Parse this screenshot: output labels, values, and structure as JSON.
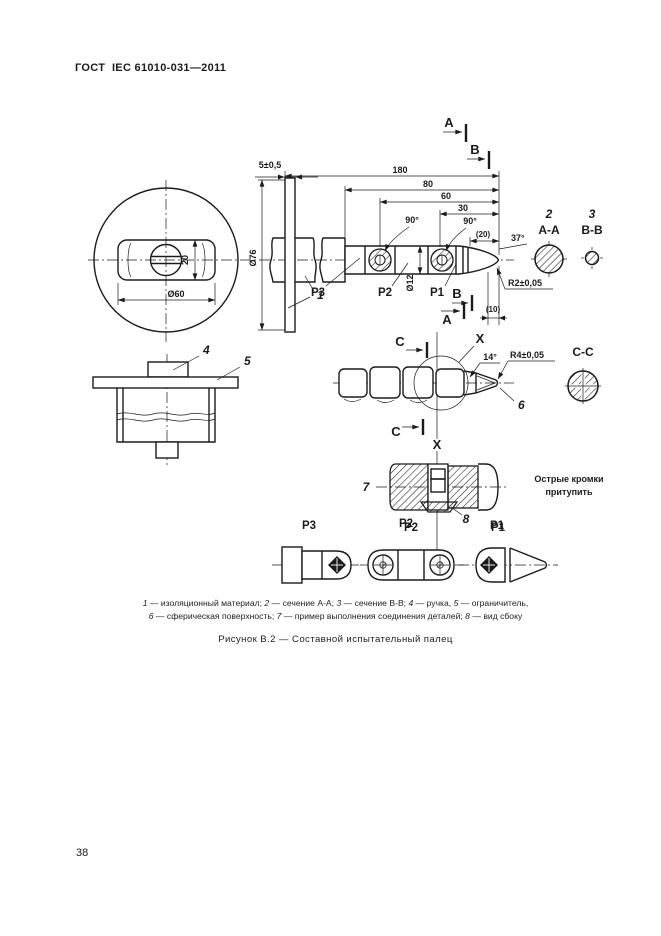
{
  "page": {
    "header": "ГОСТ  IEC 61010-031—2011",
    "page_number": "38"
  },
  "colors": {
    "ink": "#1b1b1b",
    "paper": "#ffffff"
  },
  "figure": {
    "caption": "Рисунок В.2 — Составной испытательный палец",
    "legend": {
      "line1": [
        {
          "n": "1",
          "t": " — изоляционный материал; "
        },
        {
          "n": "2",
          "t": " — сечение А-А; "
        },
        {
          "n": "3",
          "t": " — сечение В-В; "
        },
        {
          "n": "4",
          "t": " — ручка, "
        },
        {
          "n": "5",
          "t": " — ограничитель,"
        }
      ],
      "line2": [
        {
          "n": "6",
          "t": " — сферическая поверхность; "
        },
        {
          "n": "7",
          "t": " — пример выполнения соединения деталей; "
        },
        {
          "n": "8",
          "t": " — вид сбоку"
        }
      ]
    }
  },
  "drawing": {
    "dims": {
      "d180": "180",
      "d80": "80",
      "d60": "60",
      "d30": "30",
      "d5": "5±0,5",
      "d76": "Ø76",
      "d60d": "Ø60",
      "d20": "20",
      "d12": "Ø12",
      "d20p": "(20)",
      "d10p": "(10)",
      "a90": "90°",
      "a37": "37°",
      "a14": "14°",
      "r2": "R2±0,05",
      "r4": "R4±0,05"
    },
    "items": {
      "n1": "1",
      "n2": "2",
      "n3": "3",
      "n4": "4",
      "n5": "5",
      "n6": "6",
      "n7": "7",
      "n8": "8"
    },
    "sections": {
      "aa": "А-А",
      "bb": "В-В",
      "cc": "С-С"
    },
    "markers": {
      "a": "А",
      "b": "В",
      "c": "С",
      "x": "X"
    },
    "parts": {
      "p1": "P1",
      "p2": "P2",
      "p3": "P3"
    },
    "note_line1": "Острые кромки",
    "note_line2": "притупить"
  }
}
